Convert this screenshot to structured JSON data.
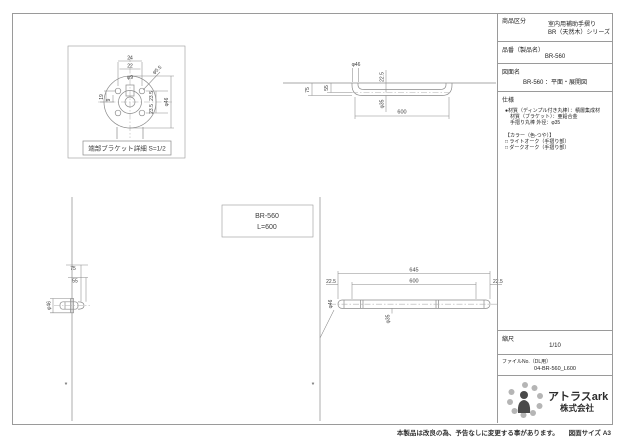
{
  "title_block": {
    "product_category_label": "商品区分",
    "product_category_line1": "室内用補助手摺り",
    "product_category_line2": "BR（天然木）シリーズ",
    "part_no_label": "品番（製品名）",
    "part_no_value": "BR-560",
    "drawing_name_label": "図面名",
    "drawing_name_value": "BR-560 ：平面・展開図",
    "spec_label": "仕様",
    "spec_lines": [
      "●材質（ディンプル付き丸棒）：積層集成材",
      "　材質（ブラケット）：亜鉛合金",
      "　手摺り丸棒 外径：φ35",
      "【カラー（色-つや）】",
      "□ ライトオーク（手摺り部）",
      "□ ダークオーク（手摺り部）"
    ],
    "scale_label": "縮尺",
    "scale_value": "1/10",
    "file_label": "ファイルNo.（DL用）",
    "file_value": "04-BR-560_L600",
    "logo_company": "アトラスark",
    "logo_suffix": "株式会社"
  },
  "notes": {
    "footer": "本製品は改良の為、予告なしに変更する事があります。",
    "paper_size": "図面サイズ A3"
  },
  "center_label": {
    "model": "BR-560",
    "length": "L=600"
  },
  "detail_view": {
    "caption": "端部ブラケット詳細 S=1/2",
    "dim_width_outer": "24",
    "dim_width_inner": "22",
    "dim_center_hole": "φ9",
    "dim_screw_hole": "φ5.5",
    "dim_left_upper": "19",
    "dim_left_lower": "9",
    "dim_right_upper": "23.5",
    "dim_right_lower": "23.5",
    "dim_flange_dia": "φ46"
  },
  "plan_view": {
    "dim_end_dia": "φ46",
    "dim_wall_offset": "22.5",
    "dim_rail_dia": "φ35",
    "dim_length": "600",
    "dim_projection_outer": "75",
    "dim_projection_inner": "55"
  },
  "side_view": {
    "dim_projection_outer": "75",
    "dim_projection_inner": "55",
    "dim_flange_dia": "φ46",
    "asterisk": "*"
  },
  "elevation_view": {
    "dim_overall": "645",
    "dim_length": "600",
    "dim_end_left": "22.5",
    "dim_end_right": "22.5",
    "dim_end_dia": "φ46",
    "dim_rail_dia": "φ35",
    "asterisk": "*"
  }
}
